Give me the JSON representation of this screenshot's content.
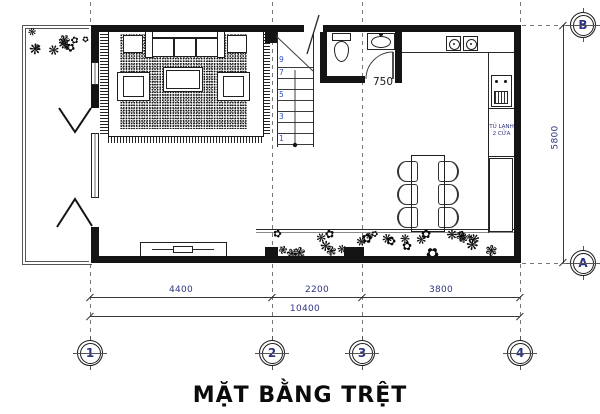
{
  "title": "MẶT BẰNG TRỆT",
  "dims": {
    "bottom": [
      "4400",
      "2200",
      "3800"
    ],
    "total": "10400",
    "height": "5800",
    "door": "750"
  },
  "grid": {
    "cols": [
      "1",
      "2",
      "3",
      "4"
    ],
    "rows": [
      "B",
      "A"
    ]
  },
  "stairs": {
    "numbers": [
      "9",
      "7",
      "5",
      "3",
      "1"
    ]
  },
  "fridge": {
    "line1": "TỦ LẠNH",
    "line2": "2 CỬA"
  },
  "icons": {
    "plant_glyphs": [
      "❋",
      "✿",
      "❃"
    ]
  },
  "colors": {
    "line": "#141414",
    "dim_text": "#2e3580",
    "stair_text": "#2d50c8"
  }
}
